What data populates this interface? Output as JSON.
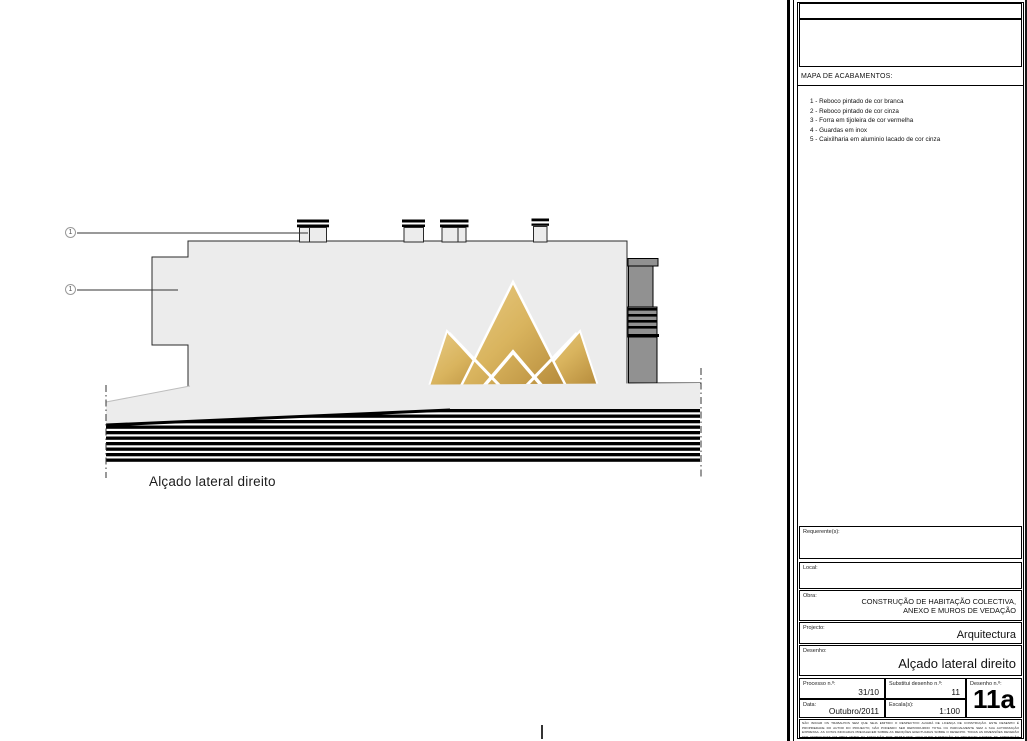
{
  "colors": {
    "gold": "#c9a227",
    "tower_gray": "#919191",
    "building_fill": "#ececec"
  },
  "drawing": {
    "caption": "Alçado lateral direito",
    "callout_1": "1",
    "callout_2": "1",
    "watermark": {
      "title": "ROYAL HOUSE",
      "subtitle": "BEYOND REAL ESTATE"
    }
  },
  "panel": {
    "mapa_title": "MAPA DE ACABAMENTOS:",
    "finishes": [
      "1 - Reboco pintado de cor branca",
      "2 - Reboco pintado de cor cinza",
      "3 - Forra em tijoleira de cor vermelha",
      "4 - Guardas em inox",
      "5 - Caixilharia em aluminio lacado de cor cinza"
    ],
    "requerente_label": "Requerente(s):",
    "local_label": "Local:",
    "obra_label": "Obra:",
    "obra_line1": "CONSTRUÇÃO DE HABITAÇÃO COLECTIVA,",
    "obra_line2": "ANEXO E MUROS DE VEDAÇÃO",
    "projecto_label": "Projecto:",
    "projecto_value": "Arquitectura",
    "desenho_label": "Desenho:",
    "desenho_value": "Alçado lateral direito",
    "processo_label": "Processo n.º:",
    "processo_value": "31/10",
    "substitui_label": "Substitui desenho n.º:",
    "substitui_value": "11",
    "desenho_n_label": "Desenho n.º:",
    "desenho_n_value": "11a",
    "data_label": "Data:",
    "data_value": "Outubro/2011",
    "escala_label": "Escala(s):",
    "escala_value": "1:100",
    "fine_print": "NÃO INICIAR OS TRABALHOS SEM QUE SEJA EMITIDO O RESPECTIVO ALVARÁ DE LICENÇA DE CONSTRUÇÃO. ESTE DESENHO É PROPRIEDADE DO AUTOR DO PROJECTO, NÃO PODENDO SER REPRODUZIDO TOTAL OU PARCIALMENTE SEM A SUA AUTORIZAÇÃO EXPRESSA. AS COTAS INDICADAS PREVALECEM SOBRE AS MEDIÇÕES EFECTUADAS SOBRE O DESENHO. TODAS AS DIMENSÕES DEVERÃO SER VERIFICADAS EM OBRA ANTES DA EXECUÇÃO DOS TRABALHOS. QUALQUER ALTERAÇÃO AO PROJECTO CARECE DE APROVAÇÃO PRÉVIA. DEC. LEI N.º 555/99 DE 16 DE DEZEMBRO E ALTERAÇÕES POSTERIORES."
  }
}
